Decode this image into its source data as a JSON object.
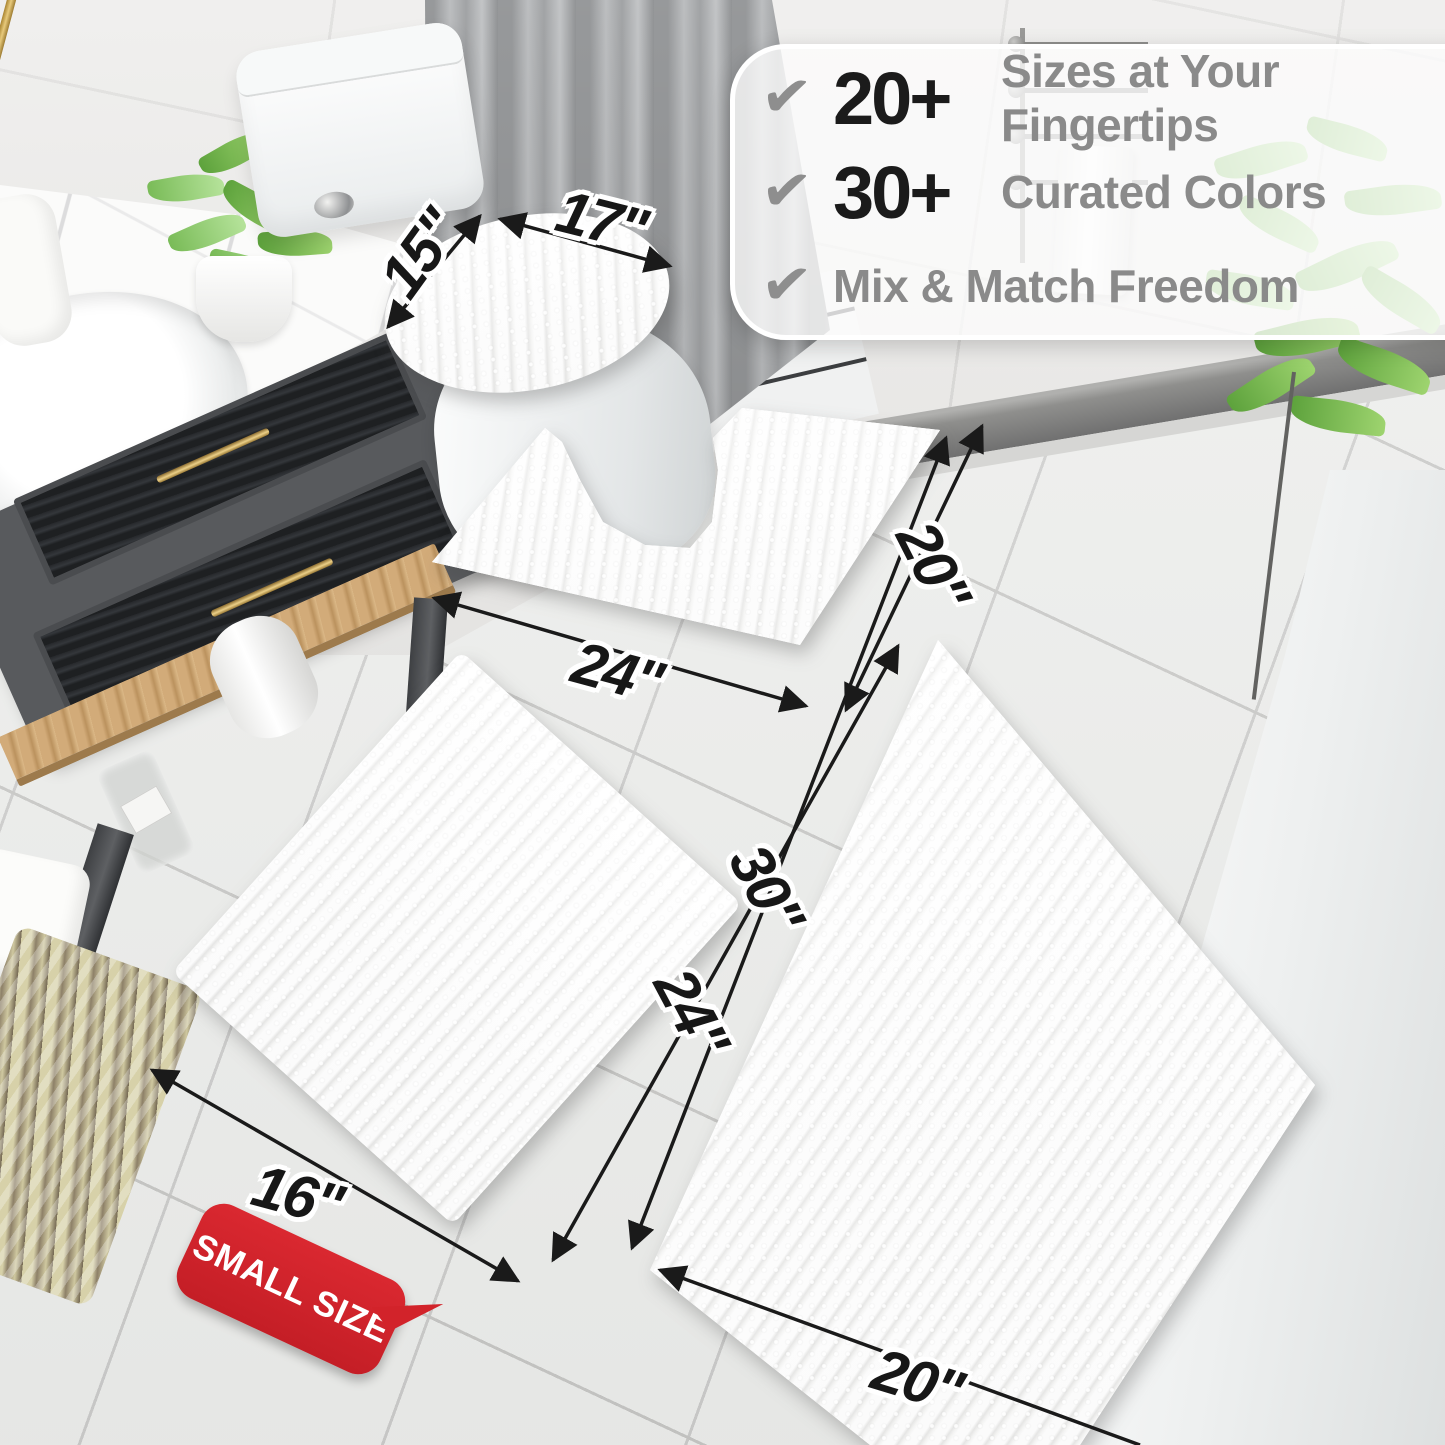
{
  "callout": {
    "items": [
      {
        "num": "20+",
        "label": "Sizes at Your Fingertips"
      },
      {
        "num": "30+",
        "label": "Curated Colors"
      },
      {
        "num": "",
        "label": "Mix & Match Freedom"
      }
    ],
    "check_glyph": "✔"
  },
  "dimensions": {
    "lid_width": "17\"",
    "lid_depth": "15\"",
    "contour_width": "24\"",
    "contour_depth": "20\"",
    "small_rug_length": "24\"",
    "small_rug_width": "16\"",
    "large_rug_length": "30\"",
    "large_rug_width": "20\""
  },
  "badge": {
    "label": "SMALL SIZE"
  },
  "colors": {
    "badge_red": "#d2232a",
    "annotation_ink": "#171717",
    "callout_number": "#1b1b1b",
    "callout_label_gray": "#8a8a8a",
    "checkmark_gray": "#8e8e8e",
    "mat_white": "#ffffff",
    "curtain_gray": "#aeb0b2",
    "vanity_gray": "#585a5d",
    "brass_gold": "#d9b469",
    "shelf_wood": "#c9a06b",
    "plant_green": "#8cc96e"
  }
}
